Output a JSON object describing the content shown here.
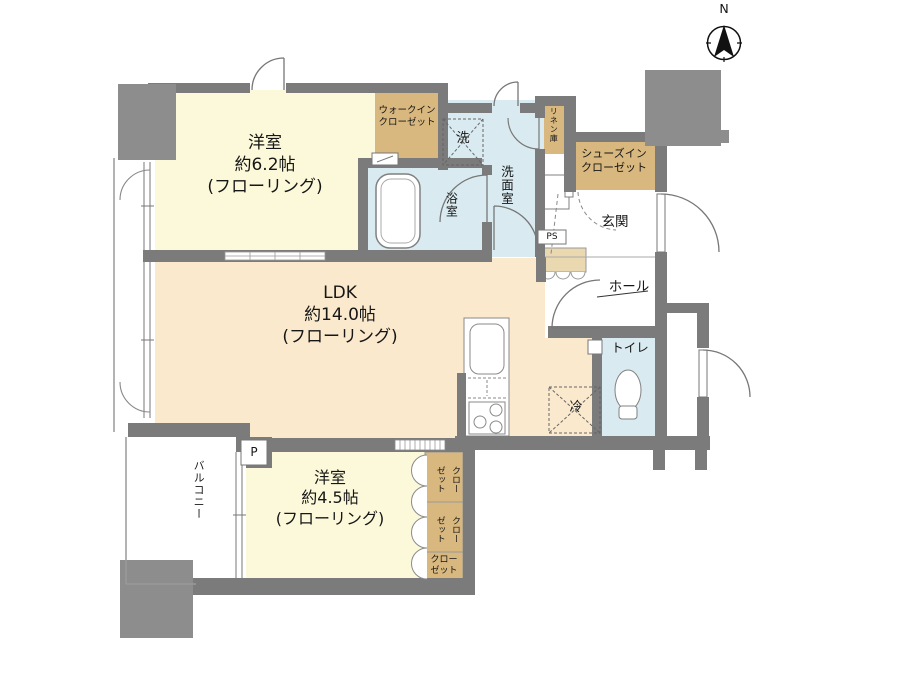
{
  "compass": {
    "label": "N"
  },
  "rooms": {
    "bedroom1": {
      "name": "洋室",
      "size": "約6.2帖",
      "floor": "(フローリング)"
    },
    "ldk": {
      "name": "LDK",
      "size": "約14.0帖",
      "floor": "(フローリング)"
    },
    "bedroom2": {
      "name": "洋室",
      "size": "約4.5帖",
      "floor": "(フローリング)"
    },
    "balcony": {
      "name": "バルコニー"
    },
    "bath": {
      "name": "浴室"
    },
    "washroom": {
      "name": "洗面室"
    },
    "toilet": {
      "name": "トイレ"
    },
    "entrance": {
      "name": "玄関"
    },
    "hall": {
      "name": "ホール"
    }
  },
  "storage": {
    "walk_in_closet": {
      "line1": "ウォークイン",
      "line2": "クローゼット"
    },
    "shoes_in_closet": {
      "line1": "シューズイン",
      "line2": "クローゼット"
    },
    "linen": {
      "name": "リネン庫"
    },
    "closet_top": {
      "line1": "クロー",
      "line2": "ゼット"
    },
    "closet_middle": {
      "line1": "クロー",
      "line2": "ゼット"
    },
    "closet_bottom": {
      "line1": "クロー",
      "line2": "ゼット"
    }
  },
  "equipment": {
    "washer": {
      "label": "洗"
    },
    "fridge": {
      "label": "冷"
    },
    "pipe_space": {
      "label": "PS"
    },
    "pipe_duct": {
      "label": "P"
    }
  },
  "colors": {
    "wall": "#7b7b7b",
    "pillar": "#8d8d8d",
    "room_yellow": "#fcf9da",
    "room_cream": "#fae9cd",
    "wet_blue": "#d9ebf1",
    "closet_tan": "#d8b87f",
    "cabinet_tan": "#ead9b0"
  }
}
